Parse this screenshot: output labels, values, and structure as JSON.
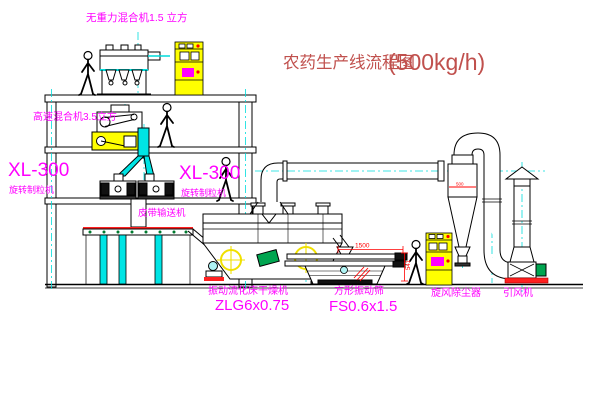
{
  "title": {
    "main": "农药生产线流程图",
    "capacity": "(500kg/h)"
  },
  "labels": {
    "top_mixer": "无重力混合机1.5 立方",
    "high_speed_mixer": "高速混合机3.5立方",
    "granulator_left_model": "XL-300",
    "granulator_left_name": "旋转制粒机",
    "granulator_right_model": "XL-300",
    "granulator_right_name": "旋转制粒机",
    "belt_conveyor": "皮带输送机",
    "dryer_name": "振动流化床干燥机",
    "dryer_model": "ZLG6x0.75",
    "screen_name": "方形振动筛",
    "screen_model": "FS0.6x1.5",
    "cyclone": "旋风除尘器",
    "fan": "引风机"
  },
  "dimensions": {
    "screen_length": "1500",
    "screen_height": "541",
    "cyclone_dia": "500"
  },
  "colors": {
    "line": "#000000",
    "centerline_cyan": "#00dcdc",
    "label_magenta": "#ff00ff",
    "dimension_red": "#ff0000",
    "equipment_yellow": "#ffff00",
    "motor_green": "#00a550",
    "title_red": "#c0504d"
  }
}
